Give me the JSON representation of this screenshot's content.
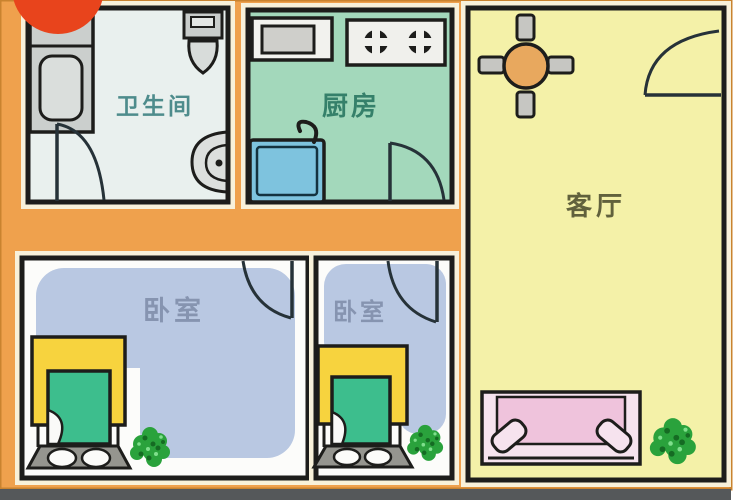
{
  "plan": {
    "rooms": {
      "bathroom": {
        "label": "卫生间",
        "label_color": "#4E8C8C",
        "floor": "#E9F0EE",
        "fixtures": [
          "bathtub-icon",
          "toilet-icon",
          "washbasin-icon",
          "door-arc-icon"
        ]
      },
      "kitchen": {
        "label": "厨房",
        "label_color": "#35806A",
        "floor": "#A3D8BB",
        "fixtures": [
          "microwave-icon",
          "stove-two-burner-icon",
          "sink-icon",
          "faucet-icon",
          "door-arc-icon"
        ]
      },
      "living_room": {
        "label": "客厅",
        "label_color": "#61613C",
        "floor": "#F4F1A8",
        "fixtures": [
          "round-dining-table-icon",
          "chair-icon",
          "entry-door-arc-icon",
          "sofa-icon",
          "plant-icon"
        ]
      },
      "bedroom_left": {
        "label": "卧室",
        "label_color": "#8694B0",
        "floor": "#FCFCFA",
        "fixtures": [
          "bed-icon",
          "blanket-icon",
          "slipper-rug-icon",
          "plant-icon",
          "door-arc-icon"
        ]
      },
      "bedroom_middle": {
        "label": "卧室",
        "label_color": "#8694B0",
        "floor": "#FCFCFA",
        "fixtures": [
          "bed-icon",
          "blanket-icon",
          "slipper-rug-icon",
          "plant-icon",
          "door-arc-icon"
        ]
      }
    },
    "palette": {
      "wall_orange": "#EFA14D",
      "outline_cream": "#F8F1DA",
      "wall_black": "#1D1D1B",
      "bedroom_blue": "#B9C8E2",
      "bed_yellow": "#F7D33E",
      "blanket_green": "#3DBE8D",
      "rug_gray": "#95958F",
      "fixture_gray": "#CBCFCD",
      "sink_blue": "#7EC3DE",
      "table_wood": "#E8A85E",
      "chair_gray": "#C6C6C2",
      "sofa_outer": "#F6E3EE",
      "sofa_inner": "#EFC3DC",
      "plant_green": "#2AA23C",
      "watermark_red": "#E8441C",
      "shadow_gray": "#55585A"
    }
  }
}
